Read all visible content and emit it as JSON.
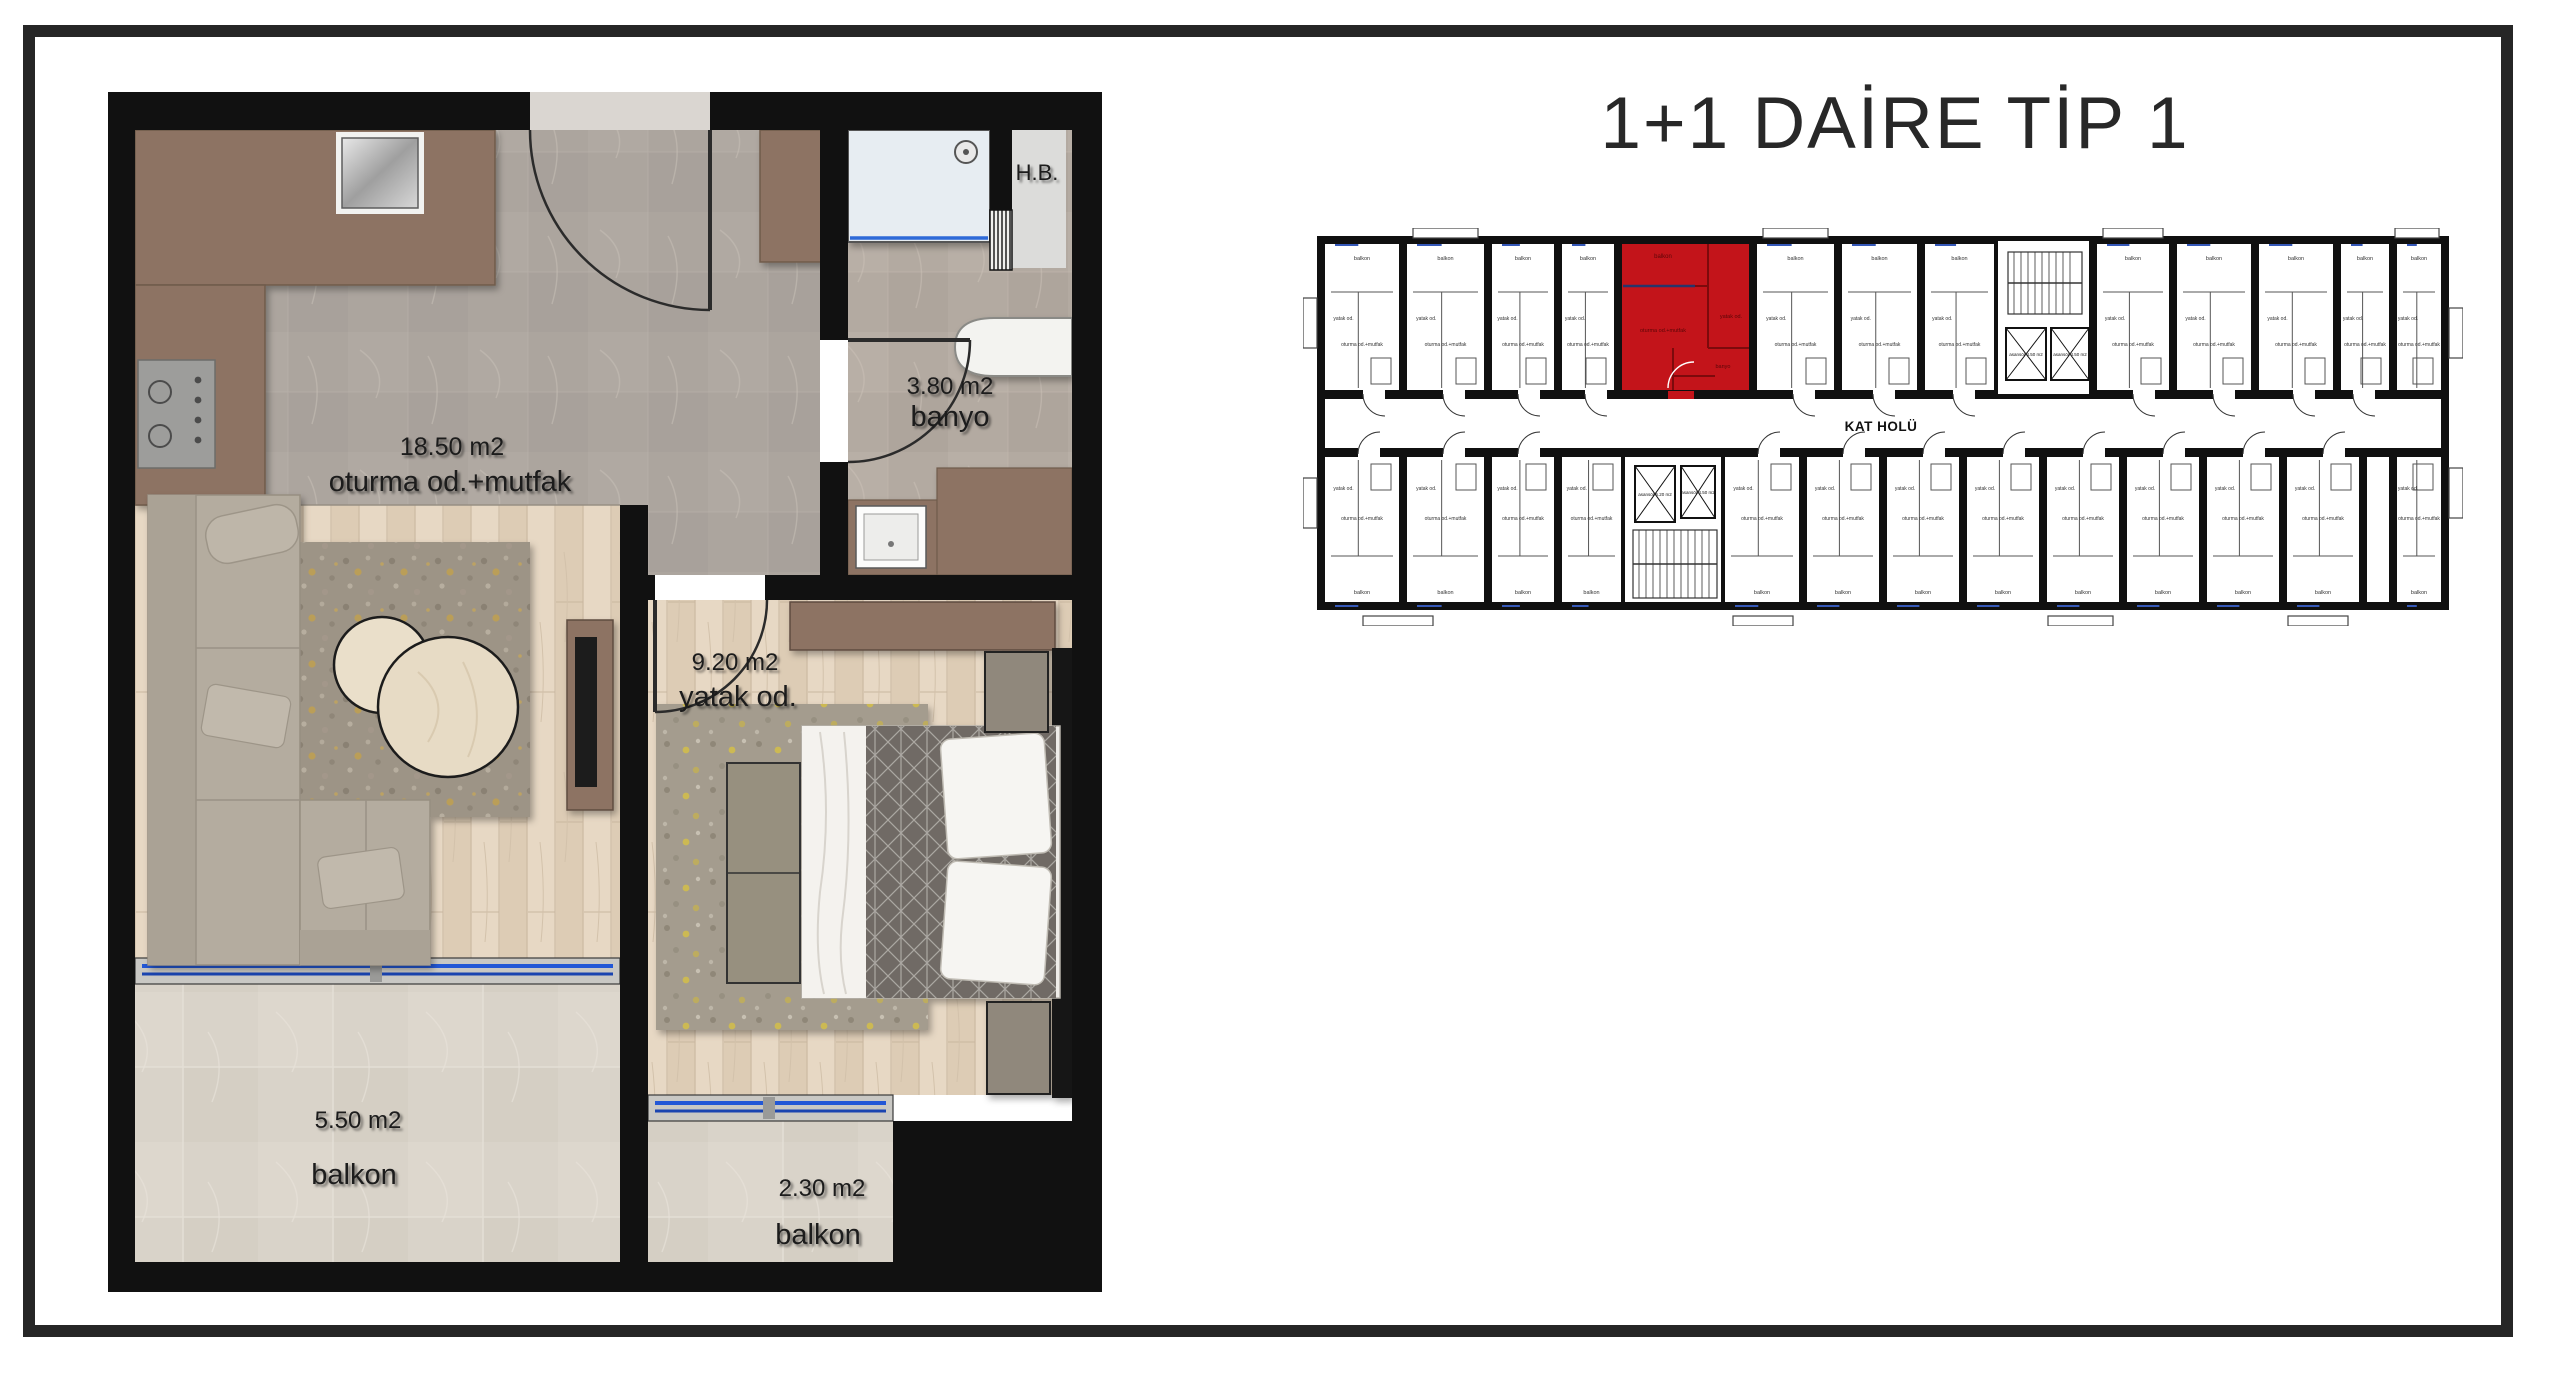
{
  "title": "1+1 DAİRE TİP 1",
  "plan": {
    "living_area": "18.50 m2",
    "living_name": "oturma od.+mutfak",
    "bath_area": "3.80 m2",
    "bath_name": "banyo",
    "bed_area": "9.20 m2",
    "bed_name": "yatak od.",
    "balcony1_area": "5.50 m2",
    "balcony1_name": "balkon",
    "balcony2_area": "2.30 m2",
    "balcony2_name": "balkon",
    "shaft_label": "H.B."
  },
  "key_plan": {
    "corridor_label": "KAT HOLÜ",
    "lift_labels": [
      "asansör 6.20 m2",
      "asansör 4.50 m2"
    ],
    "unit_labels": {
      "balcony": "balkon",
      "living": "oturma od.+mutfak",
      "bedroom": "yatak od.",
      "bath": "banyo"
    },
    "highlight_color": "#c3141a"
  },
  "colors": {
    "frame": "#262626",
    "wall": "#111111",
    "counter_brown": "#8d7363",
    "window_blue": "#2257d6"
  }
}
